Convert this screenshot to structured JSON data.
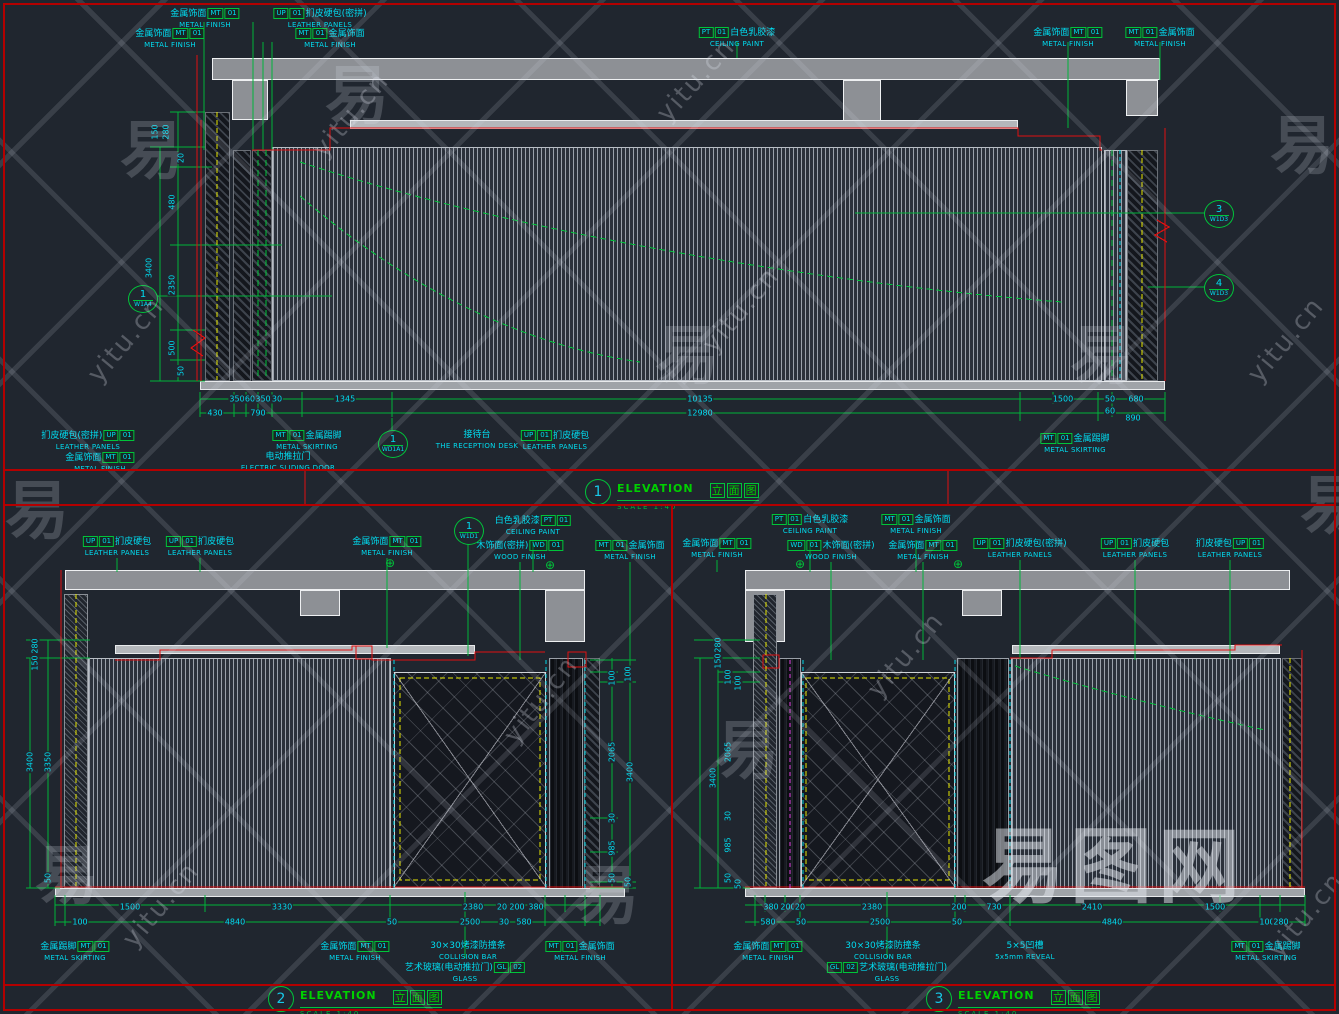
{
  "colors": {
    "background": "#20262f",
    "line_red": "#e01010",
    "line_green": "#00b43a",
    "text_cyan": "#00dcf0",
    "line_yellow": "#e8e800",
    "fill_gray": "#8d9095"
  },
  "watermark": {
    "logo": "易图网",
    "site": "yitu.cn",
    "glyph": "易",
    "site_positions": [
      {
        "x": 300,
        "y": 100,
        "r": -50
      },
      {
        "x": 75,
        "y": 325,
        "r": -50
      },
      {
        "x": 690,
        "y": 295,
        "r": -50
      },
      {
        "x": 1235,
        "y": 325,
        "r": -50
      },
      {
        "x": 490,
        "y": 685,
        "r": -52
      },
      {
        "x": 110,
        "y": 890,
        "r": -50
      },
      {
        "x": 855,
        "y": 640,
        "r": -50
      },
      {
        "x": 1255,
        "y": 900,
        "r": -50
      },
      {
        "x": 645,
        "y": 65,
        "r": -48
      }
    ],
    "glyph_positions": [
      {
        "x": 120,
        "y": 100
      },
      {
        "x": 5,
        "y": 460
      },
      {
        "x": 655,
        "y": 305
      },
      {
        "x": 1270,
        "y": 95
      },
      {
        "x": 575,
        "y": 845
      },
      {
        "x": 1070,
        "y": 305
      },
      {
        "x": 35,
        "y": 825
      },
      {
        "x": 715,
        "y": 700
      },
      {
        "x": 1300,
        "y": 455
      },
      {
        "x": 325,
        "y": 45
      }
    ]
  },
  "titles": [
    {
      "num": "1",
      "en": "ELEVATION",
      "zh": "立面图",
      "scale_label": "SCALE",
      "scale_value": "1:40",
      "x": 585,
      "y": 479
    },
    {
      "num": "2",
      "en": "ELEVATION",
      "zh": "立面图",
      "scale_label": "SCALE",
      "scale_value": "1:40",
      "x": 268,
      "y": 986
    },
    {
      "num": "3",
      "en": "ELEVATION",
      "zh": "立面图",
      "scale_label": "SCALE",
      "scale_value": "1:40",
      "x": 926,
      "y": 986
    }
  ],
  "callouts": [
    {
      "num": "1",
      "ref": "W1A4",
      "x": 142,
      "y": 298
    },
    {
      "num": "3",
      "ref": "W1D3",
      "x": 1218,
      "y": 213
    },
    {
      "num": "4",
      "ref": "W1D3",
      "x": 1218,
      "y": 287
    },
    {
      "num": "1",
      "ref": "WD1A1",
      "x": 392,
      "y": 443
    },
    {
      "num": "1",
      "ref": "W1D1",
      "x": 468,
      "y": 530
    }
  ],
  "crosshairs": [
    {
      "x": 390,
      "y": 563
    },
    {
      "x": 550,
      "y": 565
    },
    {
      "x": 800,
      "y": 564
    },
    {
      "x": 958,
      "y": 564
    }
  ],
  "tags": [
    {
      "x": 205,
      "y": 8,
      "pre": "金属饰面",
      "codes": [
        "MT",
        "01"
      ],
      "en": "METAL FINISH"
    },
    {
      "x": 170,
      "y": 28,
      "pre": "金属饰面",
      "codes": [
        "MT",
        "01"
      ],
      "en": "METAL FINISH"
    },
    {
      "x": 320,
      "y": 8,
      "codes": [
        "UP",
        "01"
      ],
      "post": "扪皮硬包(密拼)",
      "en": "LEATHER PANELS"
    },
    {
      "x": 330,
      "y": 28,
      "codes": [
        "MT",
        "01"
      ],
      "post": "金属饰面",
      "en": "METAL FINISH"
    },
    {
      "x": 737,
      "y": 27,
      "codes": [
        "PT",
        "01"
      ],
      "post": "白色乳胶漆",
      "en": "CEILING PAINT"
    },
    {
      "x": 1068,
      "y": 27,
      "pre": "金属饰面",
      "codes": [
        "MT",
        "01"
      ],
      "en": "METAL FINISH"
    },
    {
      "x": 1160,
      "y": 27,
      "codes": [
        "MT",
        "01"
      ],
      "post": "金属饰面",
      "en": "METAL FINISH"
    },
    {
      "x": 88,
      "y": 430,
      "pre": "扪皮硬包(密拼)",
      "codes": [
        "UP",
        "01"
      ],
      "en": "LEATHER PANELS"
    },
    {
      "x": 100,
      "y": 452,
      "pre": "金属饰面",
      "codes": [
        "MT",
        "01"
      ],
      "en": "METAL FINISH"
    },
    {
      "x": 307,
      "y": 430,
      "codes": [
        "MT",
        "01"
      ],
      "post": "金属踢脚",
      "en": "METAL SKIRTING"
    },
    {
      "x": 288,
      "y": 452,
      "pre": "电动推拉门",
      "en": "ELECTRIC SLIDING DOOR"
    },
    {
      "x": 477,
      "y": 430,
      "pre": "接待台",
      "en": "THE RECEPTION DESK"
    },
    {
      "x": 555,
      "y": 430,
      "codes": [
        "UP",
        "01"
      ],
      "post": "扪皮硬包",
      "en": "LEATHER PANELS"
    },
    {
      "x": 1075,
      "y": 433,
      "codes": [
        "MT",
        "01"
      ],
      "post": "金属踢脚",
      "en": "METAL SKIRTING"
    },
    {
      "x": 117,
      "y": 536,
      "codes": [
        "UP",
        "01"
      ],
      "post": "扪皮硬包",
      "en": "LEATHER PANELS"
    },
    {
      "x": 200,
      "y": 536,
      "codes": [
        "UP",
        "01"
      ],
      "post": "扪皮硬包",
      "en": "LEATHER PANELS"
    },
    {
      "x": 387,
      "y": 536,
      "pre": "金属饰面",
      "codes": [
        "MT",
        "01"
      ],
      "en": "METAL FINISH"
    },
    {
      "x": 533,
      "y": 515,
      "pre": "白色乳胶漆",
      "codes": [
        "PT",
        "01"
      ],
      "en": "CEILING PAINT"
    },
    {
      "x": 520,
      "y": 540,
      "pre": "木饰面(密拼)",
      "codes": [
        "WD",
        "01"
      ],
      "en": "WOOD FINISH"
    },
    {
      "x": 630,
      "y": 540,
      "codes": [
        "MT",
        "01"
      ],
      "post": "金属饰面",
      "en": "METAL FINISH"
    },
    {
      "x": 75,
      "y": 941,
      "pre": "金属踢脚",
      "codes": [
        "MT",
        "01"
      ],
      "en": "METAL SKIRTING"
    },
    {
      "x": 355,
      "y": 941,
      "pre": "金属饰面",
      "codes": [
        "MT",
        "01"
      ],
      "en": "METAL FINISH"
    },
    {
      "x": 468,
      "y": 941,
      "pre": "30×30烤漆防撞条",
      "en": "COLLISION BAR"
    },
    {
      "x": 465,
      "y": 962,
      "pre": "艺术玻璃(电动推拉门)",
      "codes": [
        "GL",
        "02"
      ],
      "en": "GLASS"
    },
    {
      "x": 580,
      "y": 941,
      "codes": [
        "MT",
        "01"
      ],
      "post": "金属饰面",
      "en": "METAL FINISH"
    },
    {
      "x": 717,
      "y": 538,
      "pre": "金属饰面",
      "codes": [
        "MT",
        "01"
      ],
      "en": "METAL FINISH"
    },
    {
      "x": 810,
      "y": 514,
      "codes": [
        "PT",
        "01"
      ],
      "post": "白色乳胶漆",
      "en": "CEILING PAINT"
    },
    {
      "x": 831,
      "y": 540,
      "codes": [
        "WD",
        "01"
      ],
      "post": "木饰面(密拼)",
      "en": "WOOD FINISH"
    },
    {
      "x": 916,
      "y": 514,
      "codes": [
        "MT",
        "01"
      ],
      "post": "金属饰面",
      "en": "METAL FINISH"
    },
    {
      "x": 923,
      "y": 540,
      "pre": "金属饰面",
      "codes": [
        "MT",
        "01"
      ],
      "en": "METAL FINISH"
    },
    {
      "x": 1020,
      "y": 538,
      "codes": [
        "UP",
        "01"
      ],
      "post": "扪皮硬包(密拼)",
      "en": "LEATHER PANELS"
    },
    {
      "x": 1135,
      "y": 538,
      "codes": [
        "UP",
        "01"
      ],
      "post": "扪皮硬包",
      "en": "LEATHER PANELS"
    },
    {
      "x": 1230,
      "y": 538,
      "pre": "扪皮硬包",
      "codes": [
        "UP",
        "01"
      ],
      "en": "LEATHER PANELS"
    },
    {
      "x": 768,
      "y": 941,
      "pre": "金属饰面",
      "codes": [
        "MT",
        "01"
      ],
      "en": "METAL FINISH"
    },
    {
      "x": 883,
      "y": 941,
      "pre": "30×30烤漆防撞条",
      "en": "COLLISION BAR"
    },
    {
      "x": 887,
      "y": 962,
      "codes": [
        "GL",
        "02"
      ],
      "post": "艺术玻璃(电动推拉门)",
      "en": "GLASS"
    },
    {
      "x": 1025,
      "y": 941,
      "pre": "5×5凹槽",
      "en": "5x5mm REVEAL"
    },
    {
      "x": 1266,
      "y": 941,
      "codes": [
        "MT",
        "01"
      ],
      "post": "金属踢脚",
      "en": "METAL SKIRTING"
    }
  ],
  "dims": [
    {
      "x": 155,
      "y": 132,
      "t": "150",
      "r": 1
    },
    {
      "x": 166,
      "y": 132,
      "t": "280",
      "r": 1
    },
    {
      "x": 181,
      "y": 158,
      "t": "20",
      "r": 1
    },
    {
      "x": 172,
      "y": 202,
      "t": "480",
      "r": 1
    },
    {
      "x": 149,
      "y": 268,
      "t": "3400",
      "r": 1
    },
    {
      "x": 172,
      "y": 285,
      "t": "2350",
      "r": 1
    },
    {
      "x": 172,
      "y": 348,
      "t": "500",
      "r": 1
    },
    {
      "x": 181,
      "y": 371,
      "t": "50",
      "r": 1
    },
    {
      "x": 237,
      "y": 399,
      "t": "350",
      "r": 0
    },
    {
      "x": 250,
      "y": 399,
      "t": "60",
      "r": 0
    },
    {
      "x": 263,
      "y": 399,
      "t": "350",
      "r": 0
    },
    {
      "x": 277,
      "y": 399,
      "t": "30",
      "r": 0
    },
    {
      "x": 345,
      "y": 399,
      "t": "1345",
      "r": 0
    },
    {
      "x": 700,
      "y": 399,
      "t": "10135",
      "r": 0
    },
    {
      "x": 1063,
      "y": 399,
      "t": "1500",
      "r": 0
    },
    {
      "x": 1110,
      "y": 399,
      "t": "50",
      "r": 0
    },
    {
      "x": 1136,
      "y": 399,
      "t": "680",
      "r": 0
    },
    {
      "x": 215,
      "y": 413,
      "t": "430",
      "r": 0
    },
    {
      "x": 258,
      "y": 413,
      "t": "790",
      "r": 0
    },
    {
      "x": 700,
      "y": 413,
      "t": "12980",
      "r": 0
    },
    {
      "x": 1110,
      "y": 411,
      "t": "60",
      "r": 0
    },
    {
      "x": 1133,
      "y": 418,
      "t": "890",
      "r": 0
    },
    {
      "x": 35,
      "y": 646,
      "t": "280",
      "r": 1
    },
    {
      "x": 35,
      "y": 663,
      "t": "150",
      "r": 1
    },
    {
      "x": 30,
      "y": 762,
      "t": "3400",
      "r": 1
    },
    {
      "x": 48,
      "y": 762,
      "t": "3350",
      "r": 1
    },
    {
      "x": 48,
      "y": 878,
      "t": "50",
      "r": 1
    },
    {
      "x": 612,
      "y": 678,
      "t": "100",
      "r": 1
    },
    {
      "x": 628,
      "y": 674,
      "t": "100",
      "r": 1
    },
    {
      "x": 612,
      "y": 752,
      "t": "2065",
      "r": 1
    },
    {
      "x": 630,
      "y": 772,
      "t": "3400",
      "r": 1
    },
    {
      "x": 612,
      "y": 818,
      "t": "30",
      "r": 1
    },
    {
      "x": 612,
      "y": 848,
      "t": "985",
      "r": 1
    },
    {
      "x": 612,
      "y": 878,
      "t": "50",
      "r": 1
    },
    {
      "x": 628,
      "y": 882,
      "t": "50",
      "r": 1
    },
    {
      "x": 130,
      "y": 907,
      "t": "1500",
      "r": 0
    },
    {
      "x": 282,
      "y": 907,
      "t": "3330",
      "r": 0
    },
    {
      "x": 473,
      "y": 907,
      "t": "2380",
      "r": 0
    },
    {
      "x": 502,
      "y": 907,
      "t": "20",
      "r": 0
    },
    {
      "x": 517,
      "y": 907,
      "t": "200",
      "r": 0
    },
    {
      "x": 536,
      "y": 907,
      "t": "380",
      "r": 0
    },
    {
      "x": 80,
      "y": 922,
      "t": "100",
      "r": 0
    },
    {
      "x": 235,
      "y": 922,
      "t": "4840",
      "r": 0
    },
    {
      "x": 392,
      "y": 922,
      "t": "50",
      "r": 0
    },
    {
      "x": 470,
      "y": 922,
      "t": "2500",
      "r": 0
    },
    {
      "x": 504,
      "y": 922,
      "t": "30",
      "r": 0
    },
    {
      "x": 524,
      "y": 922,
      "t": "580",
      "r": 0
    },
    {
      "x": 718,
      "y": 645,
      "t": "280",
      "r": 1
    },
    {
      "x": 718,
      "y": 661,
      "t": "150",
      "r": 1
    },
    {
      "x": 728,
      "y": 677,
      "t": "100",
      "r": 1
    },
    {
      "x": 738,
      "y": 683,
      "t": "100",
      "r": 1
    },
    {
      "x": 728,
      "y": 752,
      "t": "2065",
      "r": 1
    },
    {
      "x": 713,
      "y": 778,
      "t": "3400",
      "r": 1
    },
    {
      "x": 728,
      "y": 816,
      "t": "30",
      "r": 1
    },
    {
      "x": 728,
      "y": 845,
      "t": "985",
      "r": 1
    },
    {
      "x": 728,
      "y": 878,
      "t": "50",
      "r": 1
    },
    {
      "x": 738,
      "y": 884,
      "t": "50",
      "r": 1
    },
    {
      "x": 771,
      "y": 907,
      "t": "380",
      "r": 0
    },
    {
      "x": 788,
      "y": 907,
      "t": "200",
      "r": 0
    },
    {
      "x": 800,
      "y": 907,
      "t": "20",
      "r": 0
    },
    {
      "x": 872,
      "y": 907,
      "t": "2380",
      "r": 0
    },
    {
      "x": 959,
      "y": 907,
      "t": "200",
      "r": 0
    },
    {
      "x": 994,
      "y": 907,
      "t": "730",
      "r": 0
    },
    {
      "x": 1092,
      "y": 907,
      "t": "2410",
      "r": 0
    },
    {
      "x": 1215,
      "y": 907,
      "t": "1500",
      "r": 0
    },
    {
      "x": 768,
      "y": 922,
      "t": "580",
      "r": 0
    },
    {
      "x": 801,
      "y": 922,
      "t": "50",
      "r": 0
    },
    {
      "x": 880,
      "y": 922,
      "t": "2500",
      "r": 0
    },
    {
      "x": 957,
      "y": 922,
      "t": "50",
      "r": 0
    },
    {
      "x": 1112,
      "y": 922,
      "t": "4840",
      "r": 0
    },
    {
      "x": 1267,
      "y": 922,
      "t": "100",
      "r": 0
    },
    {
      "x": 1281,
      "y": 922,
      "t": "280",
      "r": 0
    }
  ]
}
